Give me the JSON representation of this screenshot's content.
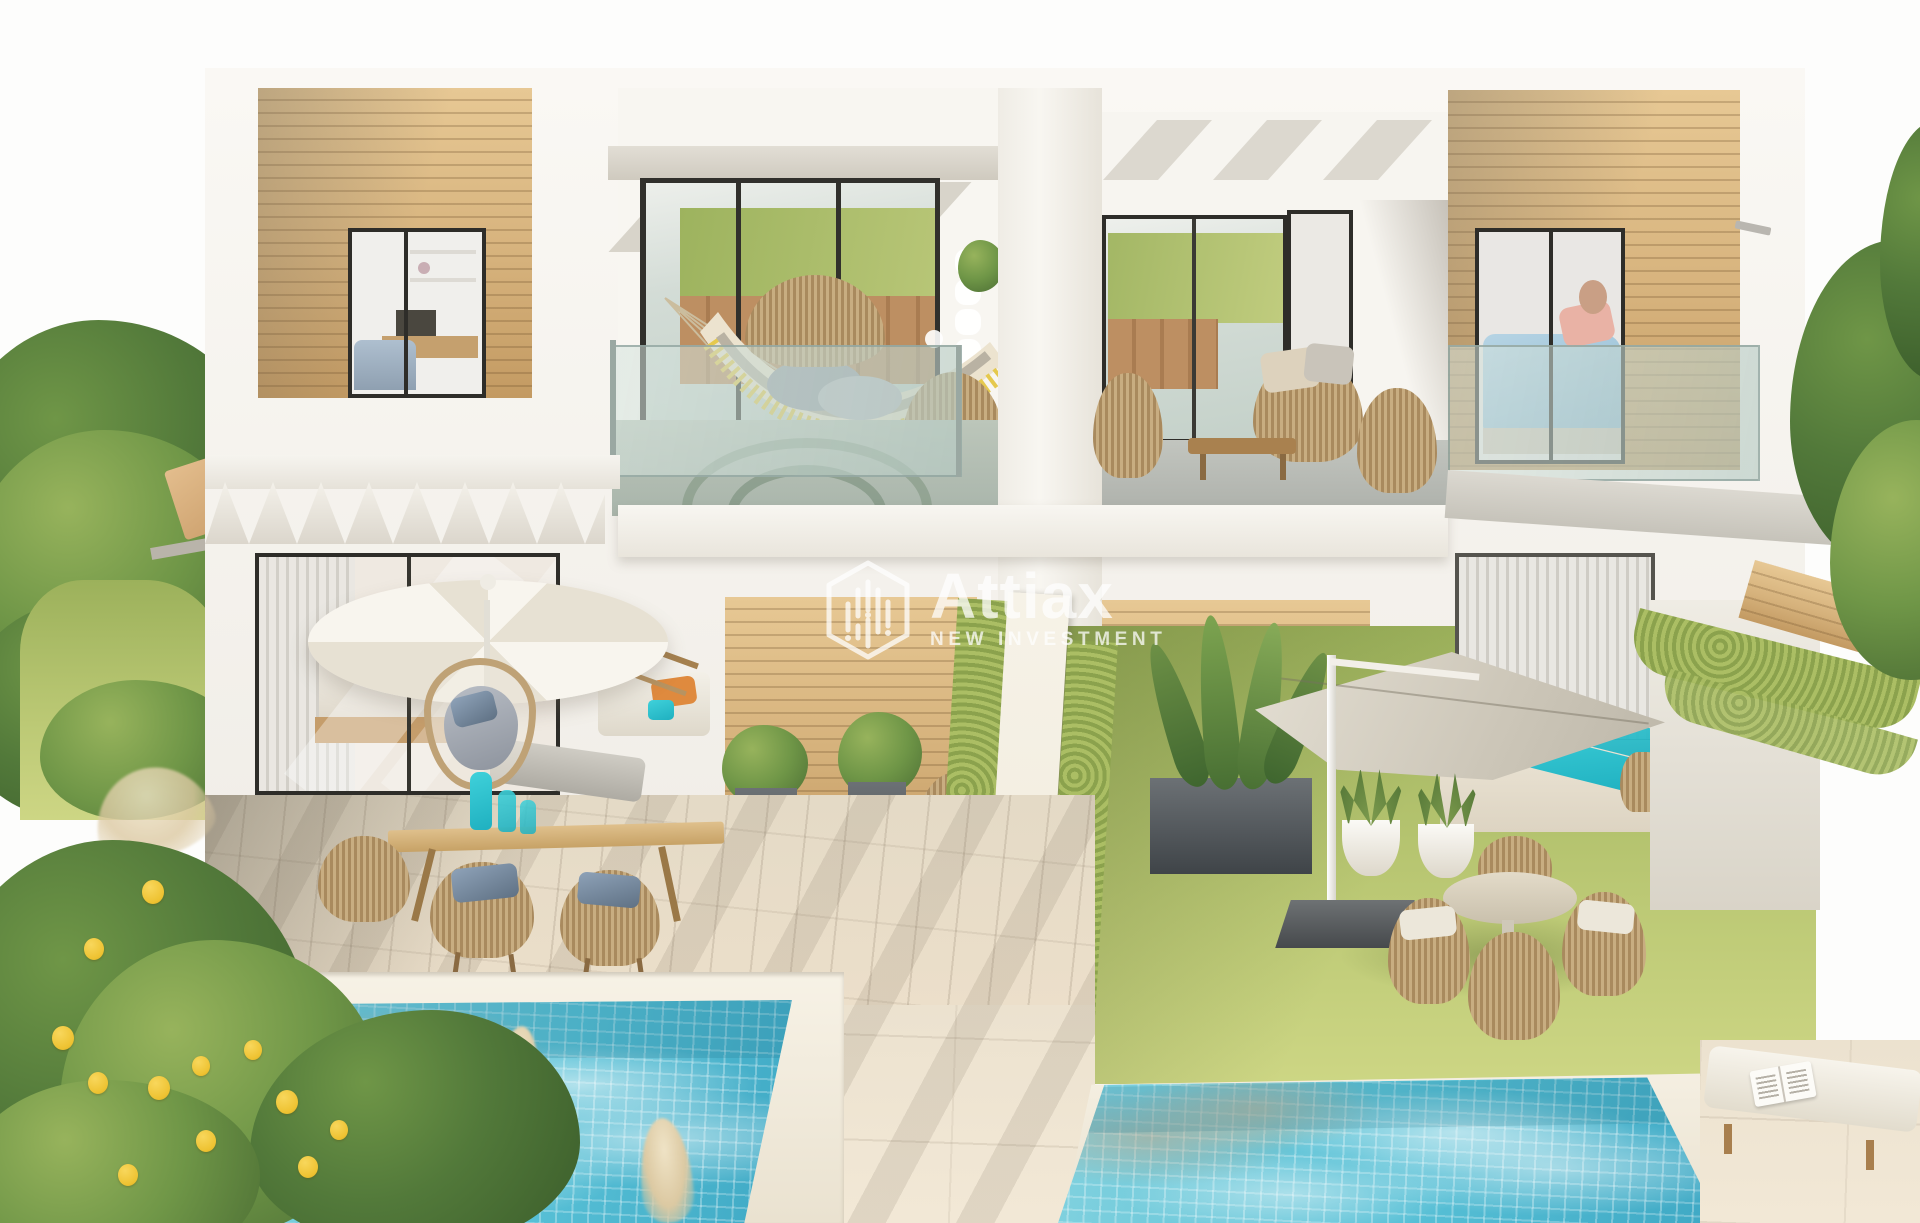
{
  "watermark": {
    "brand": "Attiax",
    "tagline": "NEW INVESTMENT",
    "logo": "hexagon-building-bars-logo"
  },
  "palette": {
    "white_wall": "#f6f4ef",
    "wall_shadow": "#ddd8cf",
    "wood_light": "#e7c894",
    "wood": "#d6b27c",
    "wood_dark": "#c39a62",
    "glass_tint": "#ccd8d1",
    "grass": "#aabb66",
    "hedge": "#93a953",
    "travertine": "#ece2cf",
    "pool_light": "#83d2df",
    "pool": "#57c0d6",
    "pool_deep": "#3ea8c4",
    "teal_cushion": "#2cc3cf",
    "lemon": "#f0c636",
    "canopy_gray": "#d6d0c4",
    "wicker": "#b99a6d",
    "tree_green": "#52793a"
  },
  "scene": {
    "type": "architectural-render",
    "subject": "modern duplex villas with private pools and gardens"
  }
}
